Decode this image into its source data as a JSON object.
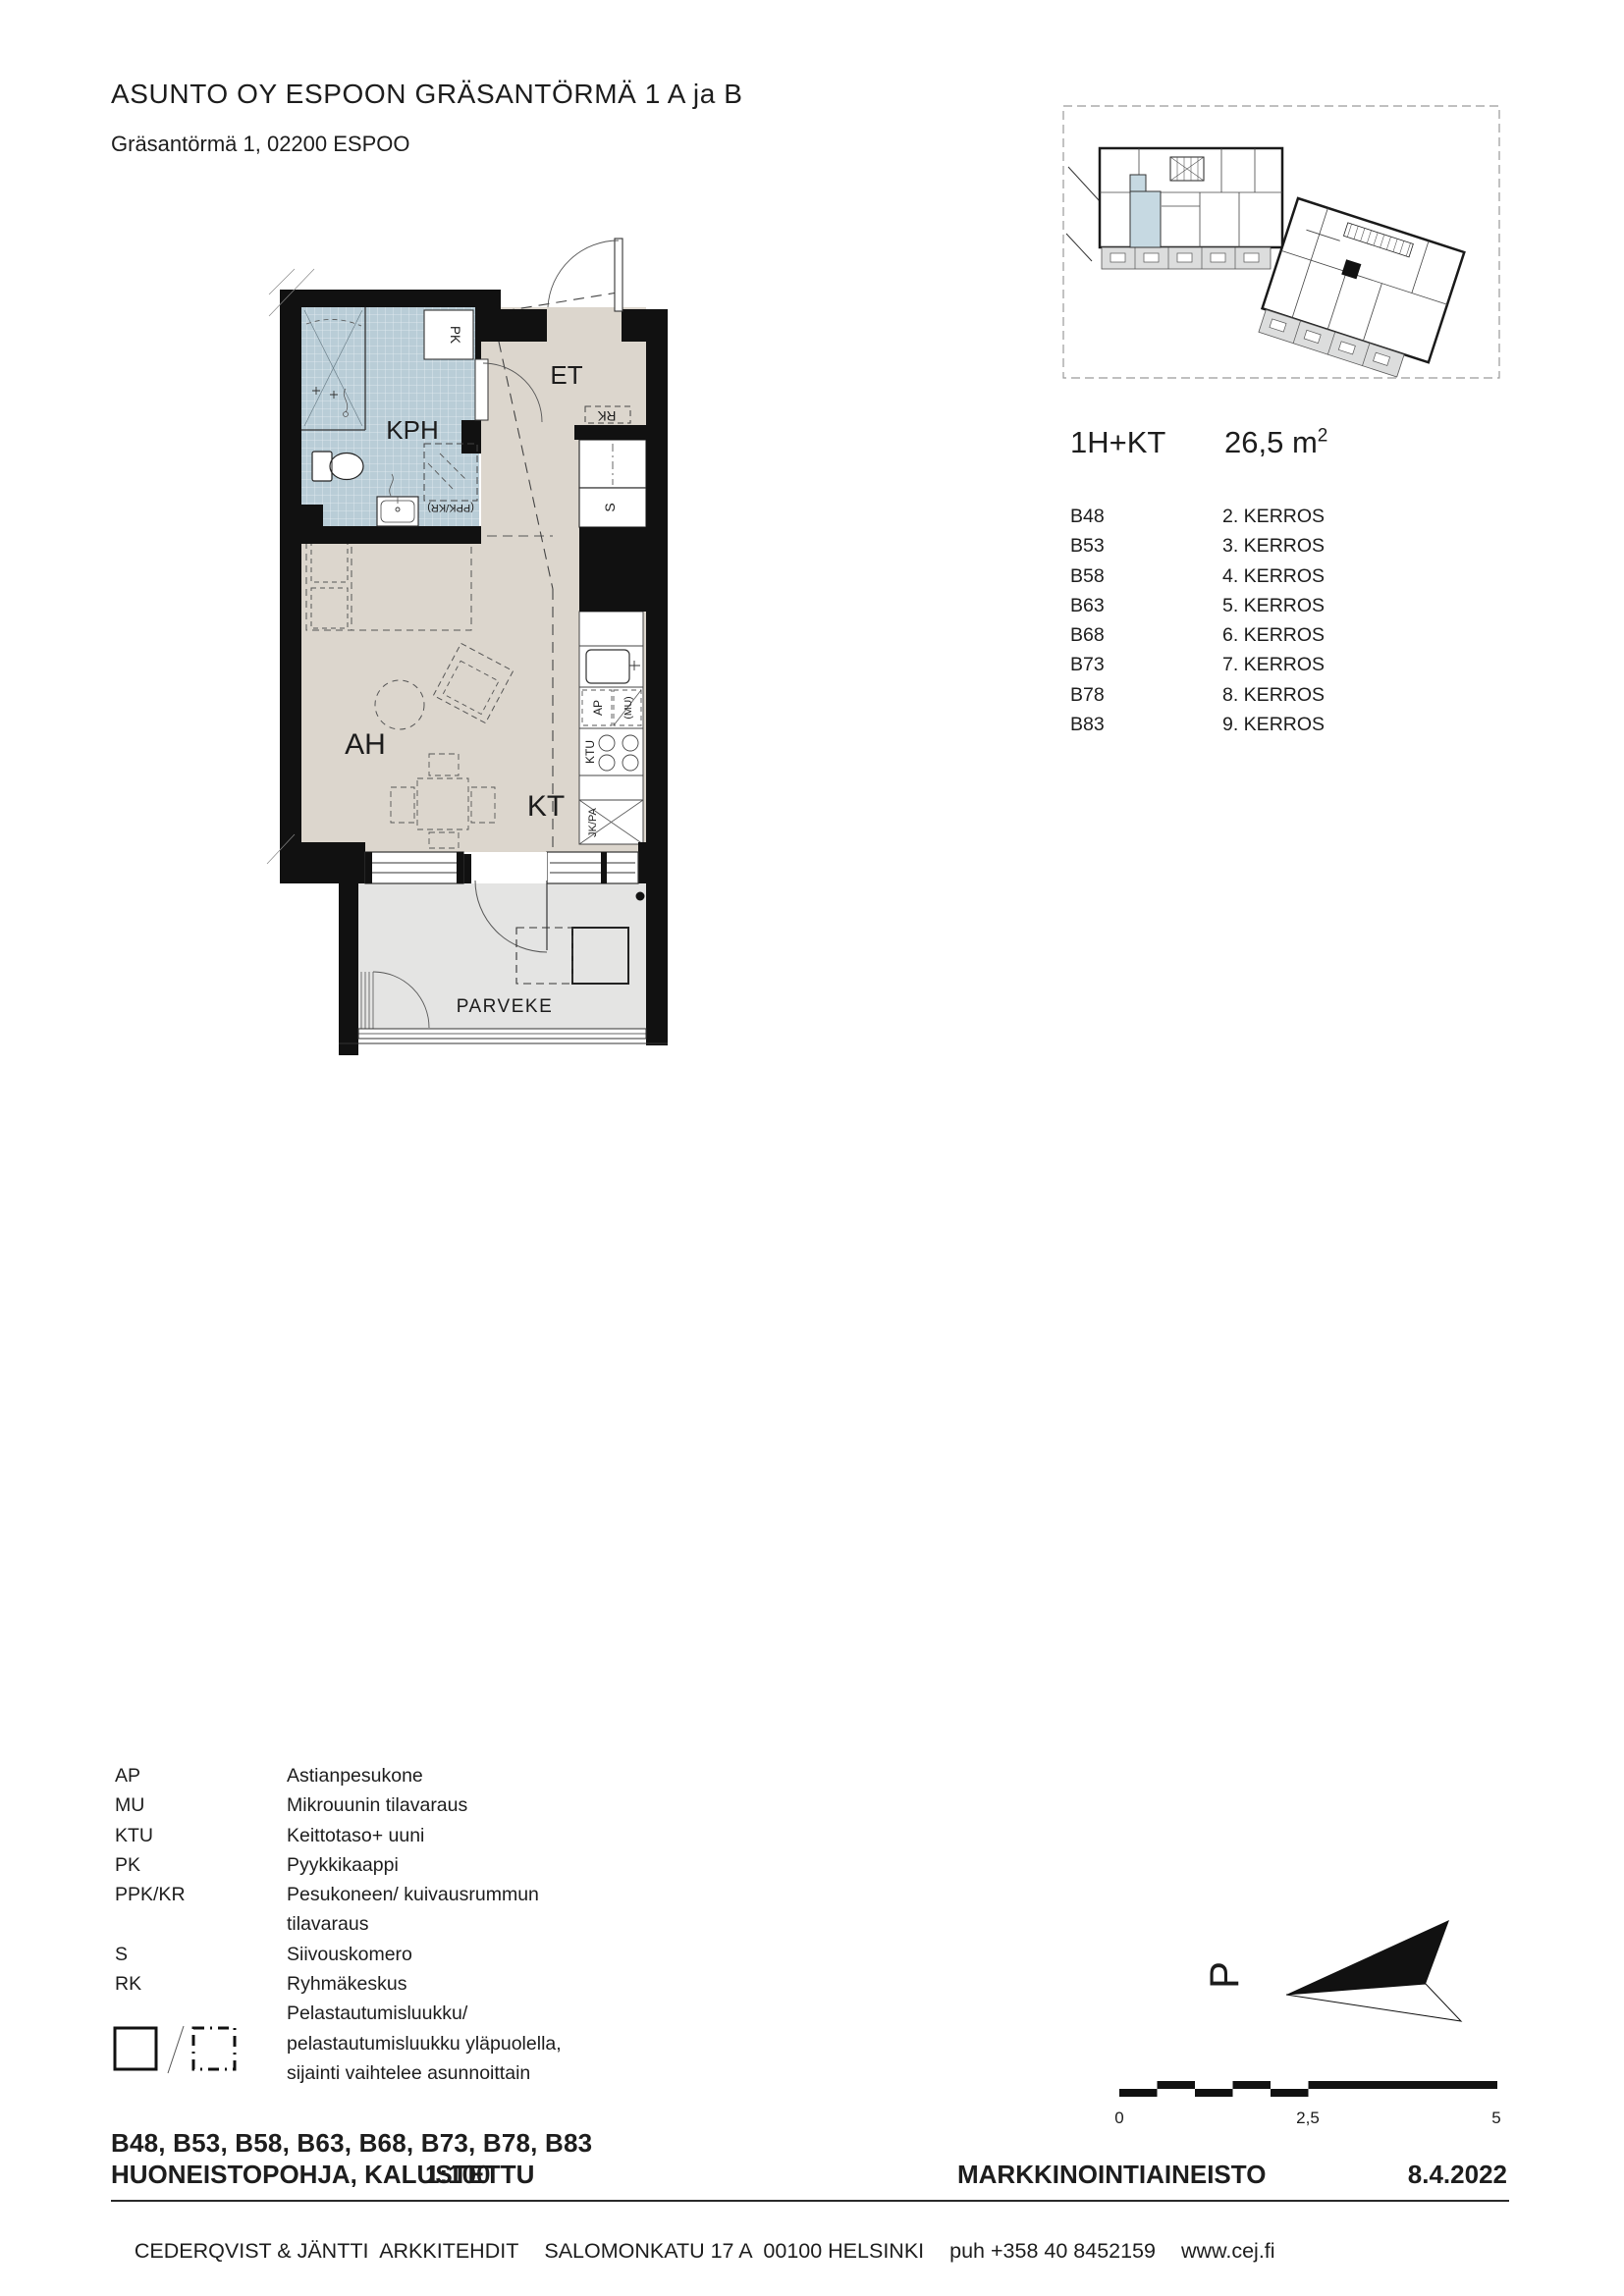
{
  "header": {
    "title": "ASUNTO OY ESPOON GRÄSANTÖRMÄ 1 A ja B",
    "address": "Gräsantörmä 1, 02200 ESPOO"
  },
  "apartment": {
    "type": "1H+KT",
    "area_value": "26,5 m",
    "area_exp": "2",
    "units": [
      {
        "id": "B48",
        "floor": "2. KERROS"
      },
      {
        "id": "B53",
        "floor": "3. KERROS"
      },
      {
        "id": "B58",
        "floor": "4. KERROS"
      },
      {
        "id": "B63",
        "floor": "5. KERROS"
      },
      {
        "id": "B68",
        "floor": "6. KERROS"
      },
      {
        "id": "B73",
        "floor": "7. KERROS"
      },
      {
        "id": "B78",
        "floor": "8. KERROS"
      },
      {
        "id": "B83",
        "floor": "9. KERROS"
      }
    ]
  },
  "plan": {
    "rooms": {
      "kph": "KPH",
      "et": "ET",
      "ah": "AH",
      "kt": "KT",
      "parveke": "PARVEKE"
    },
    "fixtures": {
      "pk": "PK",
      "ppk_kr": "(PPK/KR)",
      "rk": "RK",
      "s": "S",
      "ap": "AP",
      "mu": "(MU)",
      "ktu": "KTU",
      "jk_pa": "JK/PA"
    }
  },
  "legend": {
    "rows": [
      {
        "abbr": "AP",
        "desc": "Astianpesukone"
      },
      {
        "abbr": "MU",
        "desc": "Mikrouunin tilavaraus"
      },
      {
        "abbr": "KTU",
        "desc": "Keittotaso+ uuni"
      },
      {
        "abbr": "PK",
        "desc": "Pyykkikaappi"
      },
      {
        "abbr": "PPK/KR",
        "desc": "Pesukoneen/ kuivausrummun"
      },
      {
        "abbr": "",
        "desc": "tilavaraus"
      },
      {
        "abbr": "S",
        "desc": "Siivouskomero"
      },
      {
        "abbr": "RK",
        "desc": "Ryhmäkeskus"
      }
    ],
    "hatch_note_lines": [
      "Pelastautumisluukku/",
      "pelastautumisluukku yläpuolella,",
      "sijainti vaihtelee asunnoittain"
    ]
  },
  "title_block": {
    "unit_list": "B48, B53, B58, B63, B68, B73, B78, B83",
    "drawing_title": "HUONEISTOPOHJA, KALUSTETTU",
    "scale": "1:100",
    "material": "MARKKINOINTIAINEISTO",
    "date": "8.4.2022"
  },
  "footer": {
    "firm": "CEDERQVIST & JÄNTTI  ARKKITEHDIT",
    "address": "SALOMONKATU 17 A  00100 HELSINKI",
    "phone": "puh +358 40 8452159",
    "web": "www.cej.fi"
  },
  "north_arrow": {
    "label": "P"
  },
  "scale_bar": {
    "t0": "0",
    "t1": "2,5",
    "t2": "5"
  },
  "colors": {
    "floor_beige": "#dcd6cd",
    "bathroom_blue": "#b9cdd7",
    "balcony_grey": "#e4e4e3",
    "site_balcony_grey": "#dcdddd",
    "highlight_blue": "#c6d9e2",
    "wall_black": "#111111"
  }
}
